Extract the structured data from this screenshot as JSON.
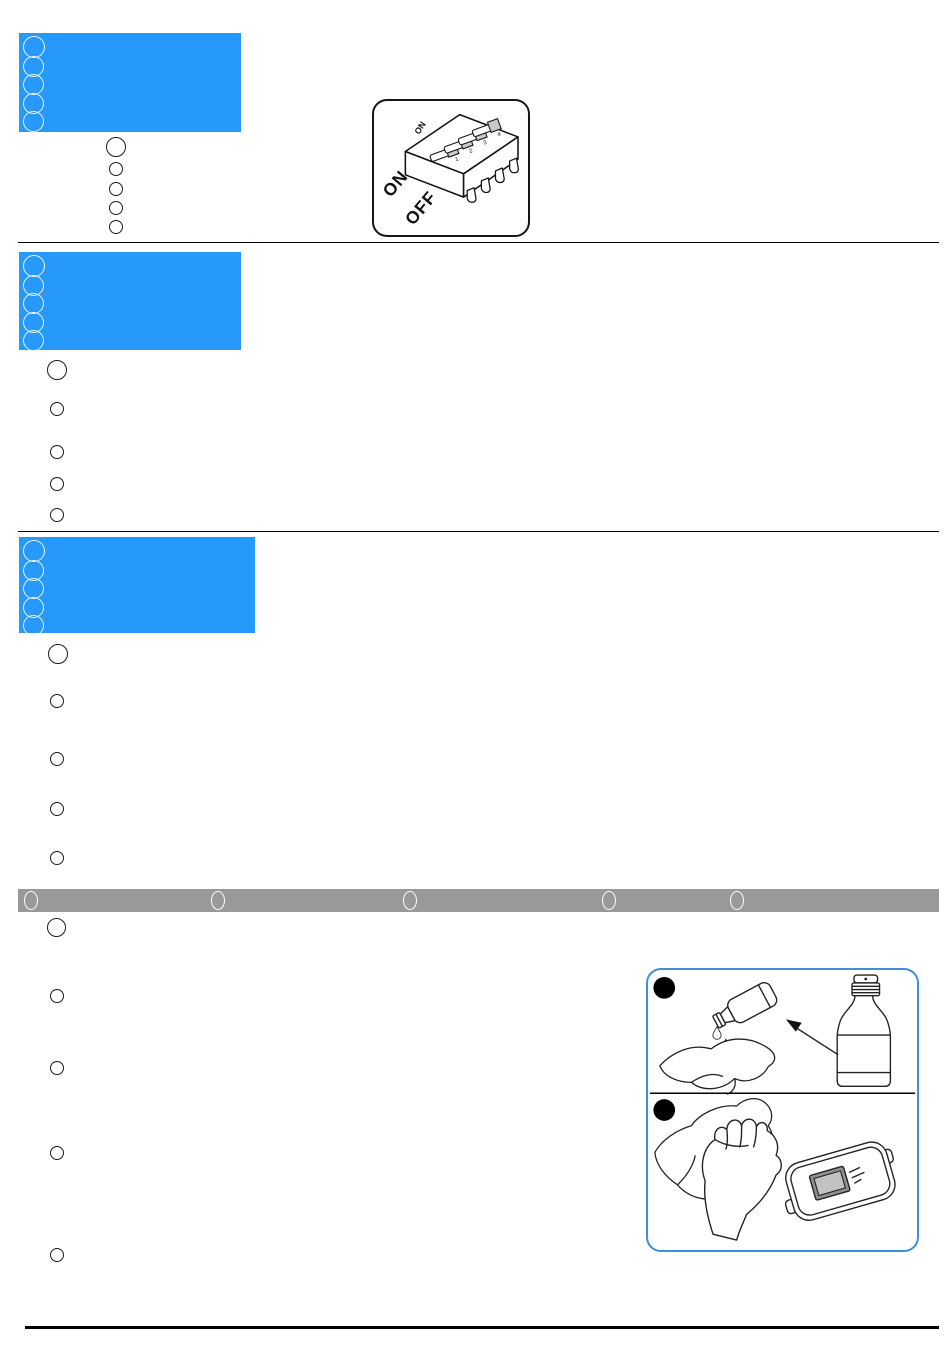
{
  "page": {
    "kind": "instruction-manual-page",
    "background": "#ffffff",
    "accent_blue": "#2699FB",
    "bar_gray": "#999999",
    "figure_border_blue": "#3E8FD8"
  },
  "sections": {
    "s1": {
      "header_bullets": 5,
      "item_bullets": 5
    },
    "s2": {
      "header_bullets": 5,
      "item_bullets": 5
    },
    "s3": {
      "header_bullets": 5,
      "item_bullets": 5
    },
    "bar": {
      "bullets": 5
    },
    "s4": {
      "item_bullets": 5
    }
  },
  "dip_switch_figure": {
    "on_label": "ON",
    "off_label": "OFF",
    "body_label": "ON",
    "position_labels": [
      "1",
      "2",
      "3",
      "4"
    ],
    "switch_count": 4
  },
  "cleaning_figure": {
    "step_count": 2,
    "panels": [
      "pour-liquid-from-bottle-onto-cloth",
      "wipe-device-with-cloth"
    ]
  }
}
